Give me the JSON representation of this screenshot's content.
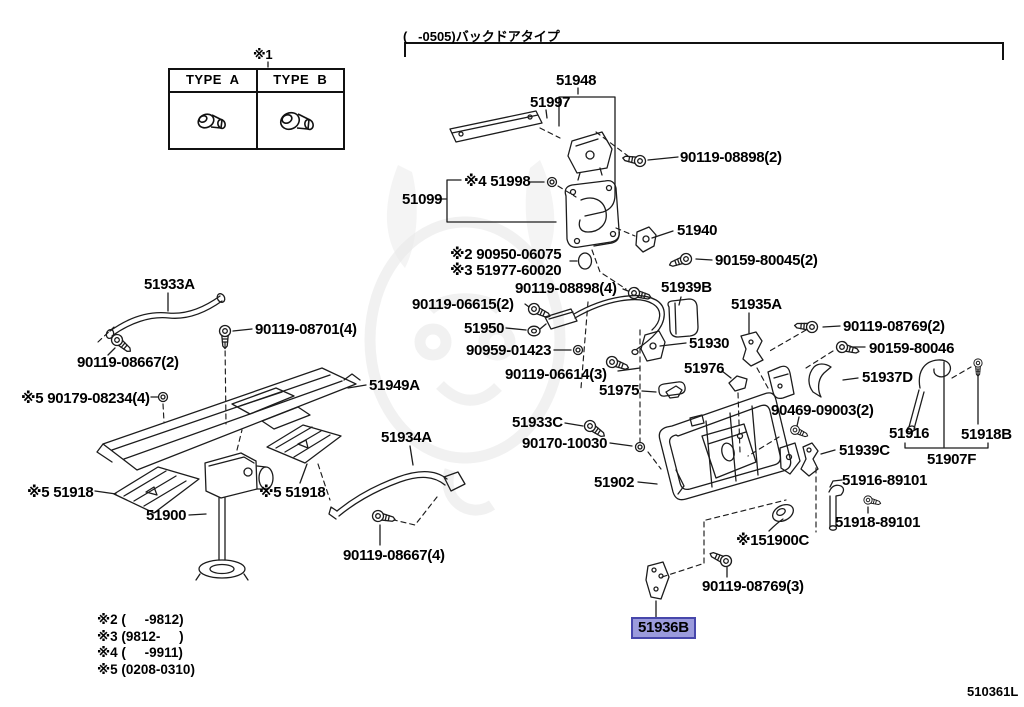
{
  "diagram": {
    "code": "510361L",
    "variant_note": "(   -0505)バックドアタイプ",
    "type_table": {
      "note": "※1",
      "col_a": "TYPE  A",
      "col_b": "TYPE  B"
    },
    "footnotes": [
      "※2 (     -9812)",
      "※3 (9812-     )",
      "※4 (     -9911)",
      "※5 (0208-0310)"
    ],
    "selected_part": {
      "number": "51936B",
      "highlight_fill": "#9b9bdc",
      "highlight_border": "#4747ab"
    }
  },
  "parts": {
    "p51948": "51948",
    "p51997": "51997",
    "p90119_08898_2": "90119-08898(2)",
    "p51998": "※4 51998",
    "p51099": "51099",
    "p51940": "51940",
    "p90950_06075": "※2 90950-06075",
    "p51977_60020": "※3 51977-60020",
    "p90159_80045_2": "90159-80045(2)",
    "p90119_08898_4": "90119-08898(4)",
    "p51939B": "51939B",
    "p51935A": "51935A",
    "p51933A": "51933A",
    "p90119_06615_2": "90119-06615(2)",
    "p90119_08701_4": "90119-08701(4)",
    "p51950": "51950",
    "p90119_08769_2": "90119-08769(2)",
    "p90159_80046": "90159-80046",
    "p90119_08667_2": "90119-08667(2)",
    "p90959_01423": "90959-01423",
    "p51930": "51930",
    "p51949A": "51949A",
    "p90119_06614_3": "90119-06614(3)",
    "p51937D": "51937D",
    "p51975": "51975",
    "p51976": "51976",
    "p90179_08234_4": "※5 90179-08234(4)",
    "p90469_09003_2": "90469-09003(2)",
    "p51933C": "51933C",
    "p51916": "51916",
    "p51918B": "51918B",
    "p90170_10030": "90170-10030",
    "p51934A": "51934A",
    "p51939C": "51939C",
    "p51907F": "51907F",
    "p51918_left": "※5 51918",
    "p51918_right": "※5 51918",
    "p51902": "51902",
    "p51916_89101": "51916-89101",
    "p51900": "51900",
    "p51918_89101": "51918-89101",
    "p51900C": "※151900C",
    "p90119_08667_4": "90119-08667(4)",
    "p90119_08769_3": "90119-08769(3)",
    "p51936B": "51936B"
  }
}
